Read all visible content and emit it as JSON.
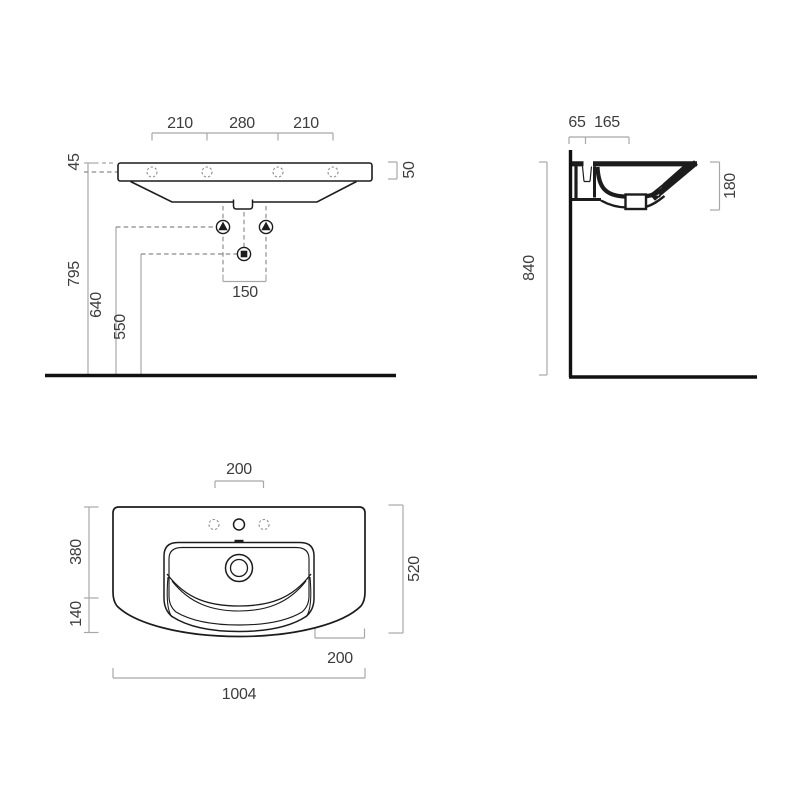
{
  "page": {
    "background": "#ffffff",
    "kind": "sanitaryware technical dimension drawing"
  },
  "colors": {
    "drawing_line": "#1c1c1c",
    "dimension_line": "#a8a8a8",
    "construction_dash": "#8a8a8a",
    "dimension_text": "#3d3d3d"
  },
  "symbols": {
    "fixing_point": "triangle-up-in-circle",
    "waste_outlet": "square-in-circle",
    "tap_hole": "dashed-circle"
  },
  "views": {
    "front": {
      "title": "front elevation",
      "dimensions": {
        "tap_left": "210",
        "tap_center": "280",
        "tap_right": "210",
        "deck_back_thickness": "45",
        "deck_front_thickness": "50",
        "underside_height": "795",
        "fixing_height": "640",
        "trap_height": "550",
        "fixing_spacing": "150"
      }
    },
    "side": {
      "title": "side section",
      "dimensions": {
        "wall_to_tap": "65",
        "tap_to_front": "165",
        "basin_depth": "180",
        "deck_height": "840"
      }
    },
    "plan": {
      "title": "plan view",
      "dimensions": {
        "tap_spacing": "200",
        "bowl_depth": "380",
        "apron_depth": "140",
        "overall_depth": "520",
        "side_to_bowl": "200",
        "overall_width": "1004"
      }
    }
  }
}
